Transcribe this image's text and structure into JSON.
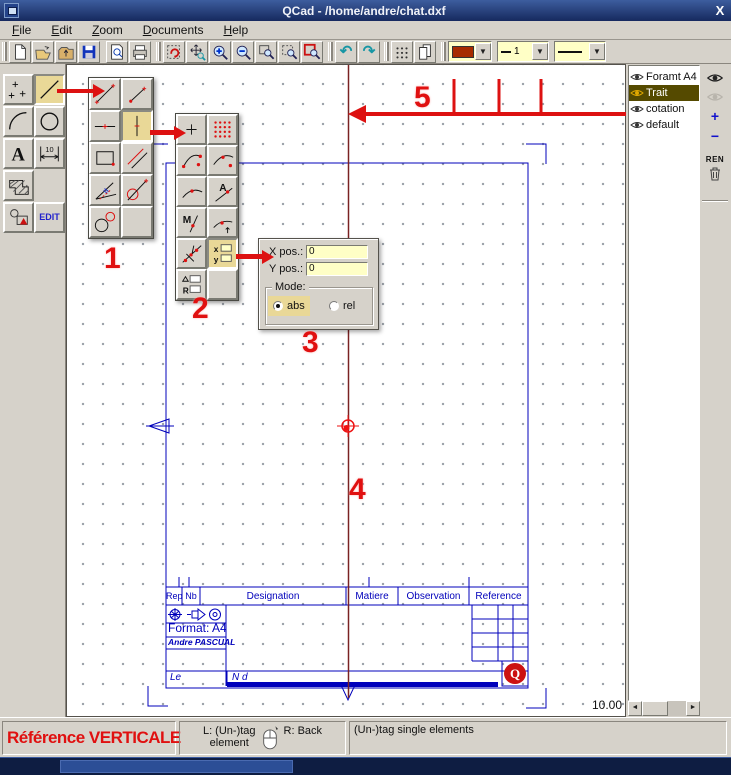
{
  "window": {
    "title": "QCad - /home/andre/chat.dxf",
    "close_glyph": "X"
  },
  "menu": {
    "items": [
      {
        "label": "File"
      },
      {
        "label": "Edit"
      },
      {
        "label": "Zoom"
      },
      {
        "label": "Documents"
      },
      {
        "label": "Help"
      }
    ]
  },
  "toolbar": {
    "icons": [
      "new-document",
      "open-file",
      "import-file",
      "save-file",
      "print-preview",
      "print",
      "redraw",
      "pan-zoom",
      "zoom-in",
      "zoom-out",
      "zoom-window",
      "zoom-auto",
      "zoom-previous",
      "undo",
      "redo",
      "grid-toggle",
      "layer-list"
    ],
    "undo_glyph": "↶",
    "redo_glyph": "↷",
    "drop_glyph": "▼",
    "color_swatch": "#a62b00",
    "width_value": "1"
  },
  "left_toolbar": {
    "tools": [
      "points",
      "lines",
      "arcs",
      "circles",
      "texts",
      "dimensions",
      "hatches",
      "tag-elements",
      "edit-mode"
    ],
    "text_tool_glyph": "A",
    "dim_glyph": "10",
    "edit_label": "EDIT"
  },
  "palette_lines": {
    "buttons": [
      "line-two-points",
      "line-point-angle",
      "line-horizontal",
      "line-vertical",
      "rectangle",
      "line-parallel",
      "line-bisector",
      "line-tangent-point-circle",
      "line-tangent-two-circles"
    ],
    "selected": "line-vertical"
  },
  "palette_snap": {
    "buttons": [
      "snap-free",
      "snap-grid",
      "snap-endpoints",
      "snap-on-entity",
      "snap-middle",
      "snap-auto",
      "snap-manual",
      "snap-distance",
      "snap-intersection",
      "snap-xy",
      "snap-angle-radius"
    ],
    "selected": "snap-xy",
    "glyph_a": "A",
    "glyph_m": "M",
    "glyph_x": "x",
    "glyph_y": "y",
    "glyph_r": "R"
  },
  "snap_dialog": {
    "x_label": "X pos.:",
    "x_value": "0",
    "y_label": "Y pos.:",
    "y_value": "0",
    "mode_label": "Mode:",
    "abs_label": "abs",
    "rel_label": "rel",
    "selected_mode": "abs"
  },
  "canvas": {
    "grid_spacing": "10.00",
    "title_block": {
      "headers": [
        "Rep",
        "Nb",
        "Designation",
        "Matiere",
        "Observation",
        "Reference"
      ],
      "format": "Format: A4",
      "author": "Andre PASCUAL",
      "date_label": "Le",
      "number_label": "N d",
      "logo_glyph": "Q"
    }
  },
  "annotations": {
    "numbers": [
      "1",
      "2",
      "3",
      "4",
      "5"
    ],
    "color": "#e01010"
  },
  "layer_panel": {
    "layers": [
      {
        "name": "Foramt A4",
        "selected": false
      },
      {
        "name": "Trait",
        "selected": true
      },
      {
        "name": "cotation",
        "selected": false
      },
      {
        "name": "default",
        "selected": false
      }
    ],
    "buttons": {
      "add": "+",
      "remove": "−",
      "rename": "REN"
    }
  },
  "statusbar": {
    "left": "Référence VERTICALE",
    "mouse_left_line1": "L: (Un-)tag",
    "mouse_left_line2": "element",
    "mouse_right": "R: Back",
    "right": "(Un-)tag single elements"
  },
  "colors": {
    "annotation_red": "#e01010",
    "drawing_blue": "#0000bb",
    "reference_line": "#7a2222",
    "selected_tool_bg": "#e9d897",
    "layer_selected_bg": "#554a00",
    "field_yellow": "#ffffc6"
  }
}
